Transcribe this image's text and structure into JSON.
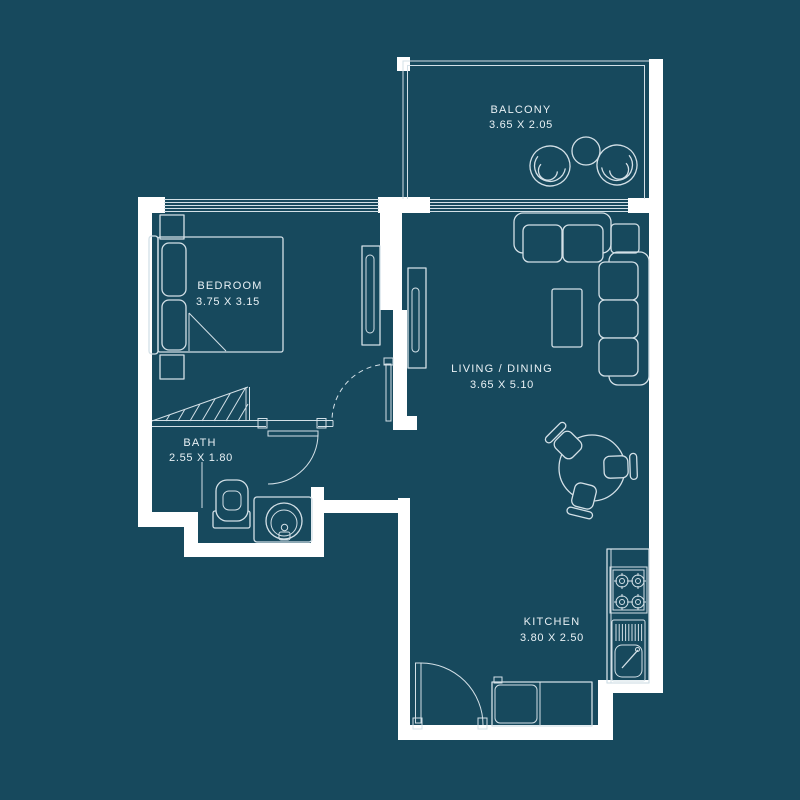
{
  "palette": {
    "background": "#17495d",
    "wall": "#ffffff",
    "line": "#d3e0e7",
    "text": "#e9f1f5"
  },
  "floorplan": {
    "rooms": [
      {
        "name": "BALCONY",
        "dimensions": "3.65 X 2.05"
      },
      {
        "name": "BEDROOM",
        "dimensions": "3.75 X 3.15"
      },
      {
        "name": "LIVING / DINING",
        "dimensions": "3.65 X 5.10"
      },
      {
        "name": "BATH",
        "dimensions": "2.55 X 1.80"
      },
      {
        "name": "KITCHEN",
        "dimensions": "3.80 X 2.50"
      }
    ]
  }
}
